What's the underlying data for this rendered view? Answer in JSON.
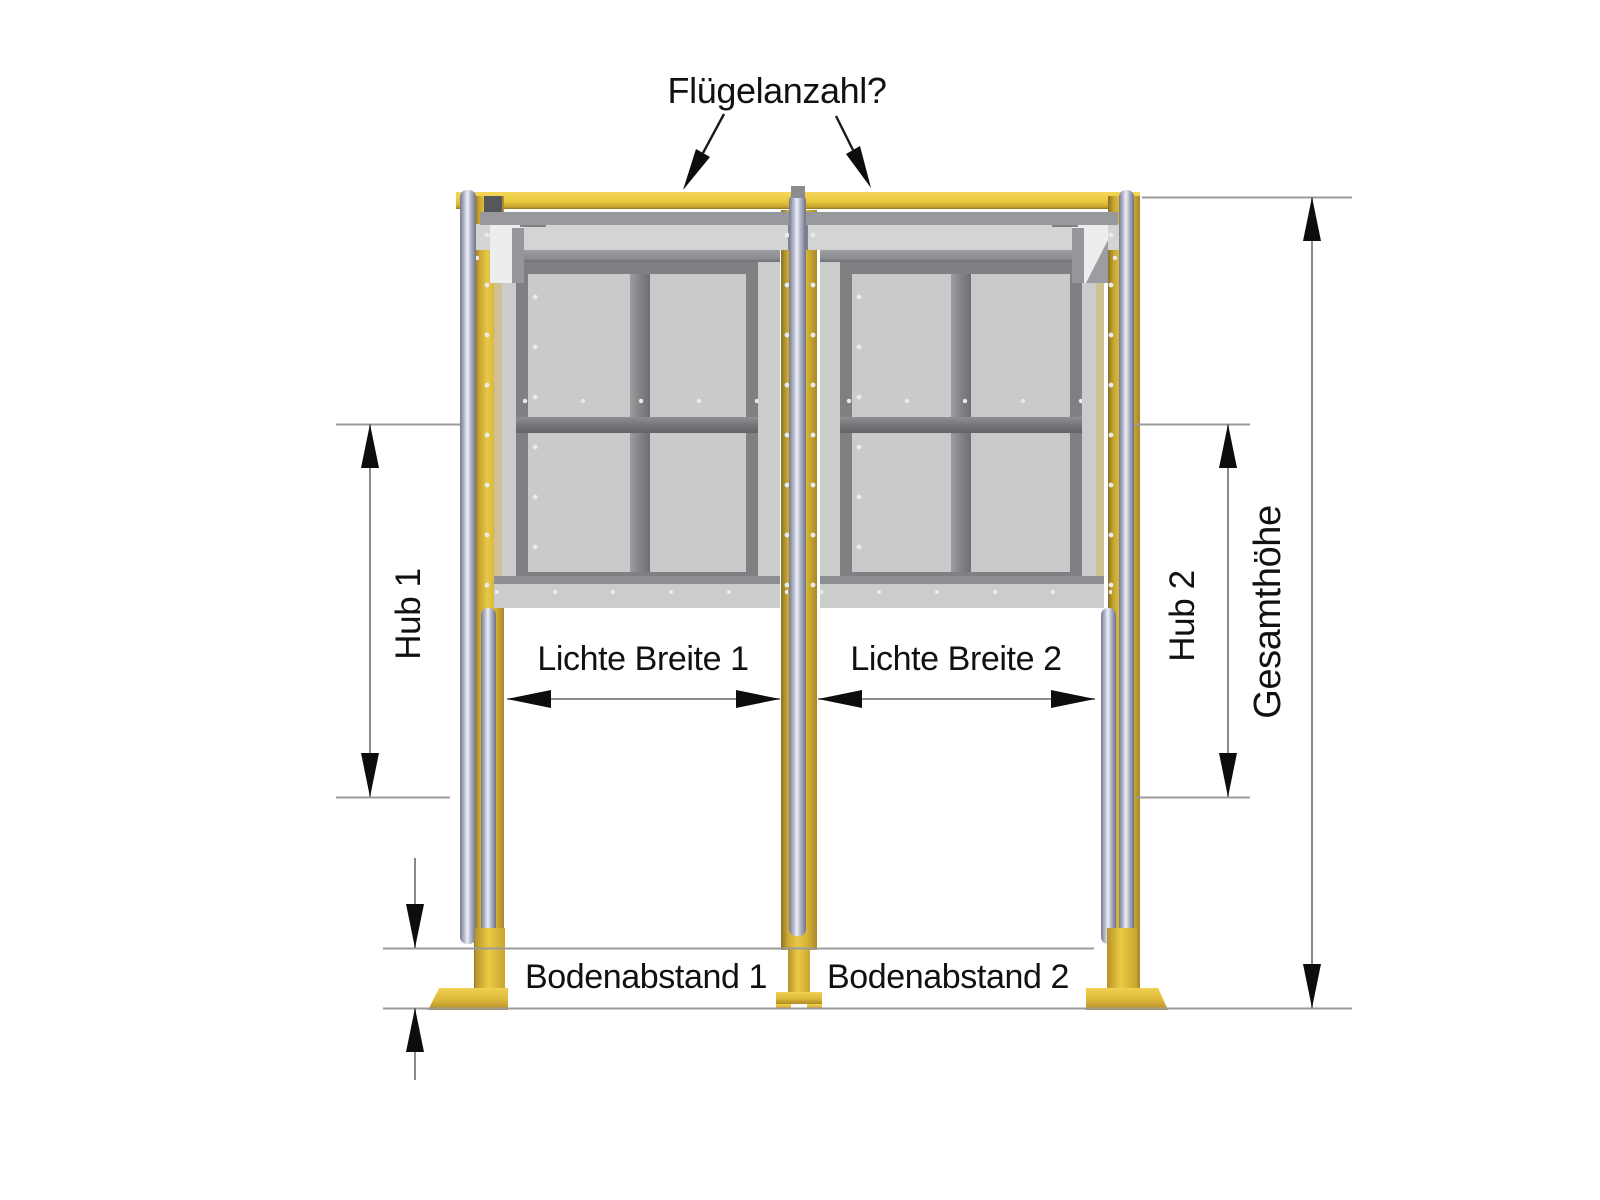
{
  "annotation": {
    "flap_count_question": "Flügelanzahl?",
    "hub_1": "Hub 1",
    "hub_2": "Hub 2",
    "total_height": "Gesamthöhe",
    "clear_width_1": "Lichte Breite 1",
    "clear_width_2": "Lichte Breite 2",
    "floor_clearance_1": "Bodenabstand 1",
    "floor_clearance_2": "Bodenabstand 2"
  },
  "colors": {
    "background": "#ffffff",
    "text": "#111111",
    "frame_yellow": "#e5c23d",
    "yellow_dark": "#b08c25",
    "chrome_light": "#eef0f7",
    "chrome_dark": "#767a8e",
    "panel_light": "#cbcdcd",
    "panel_lighter": "#d3d5d5",
    "profile_gray": "#7e8083",
    "rail_dark": "#3d3f42",
    "track_gray": "#9ca0a2",
    "cutout_white": "#ededed",
    "dim_line": "#7d7d7d",
    "ext_line": "#9b9b9b",
    "arrow_black": "#0d0d0d"
  }
}
